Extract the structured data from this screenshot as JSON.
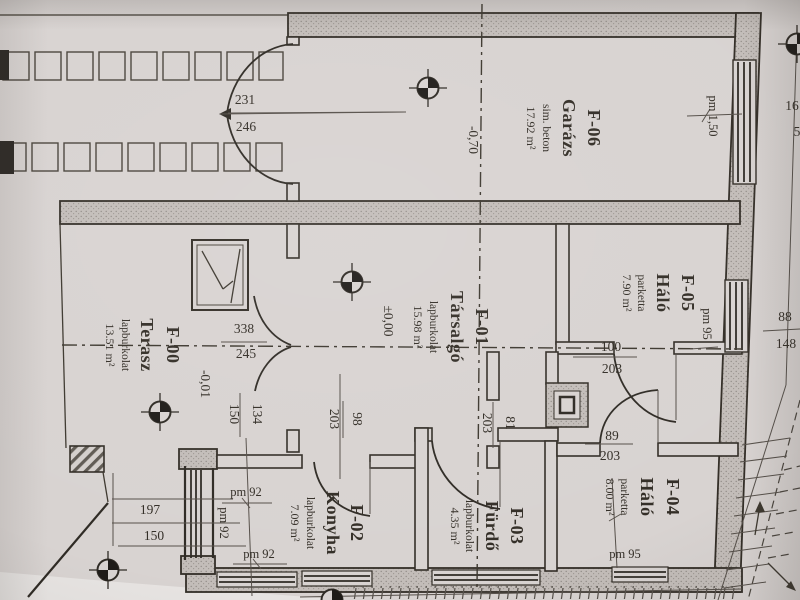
{
  "plan": {
    "rooms": [
      {
        "id": "F-06",
        "name": "Garázs",
        "floor": "sim. beton",
        "area": "17.92 m²"
      },
      {
        "id": "F-05",
        "name": "Háló",
        "floor": "parketta",
        "area": "7.90 m²"
      },
      {
        "id": "F-01",
        "name": "Társalgó",
        "floor": "lapburkolat",
        "area": "15.98 m²"
      },
      {
        "id": "F-00",
        "name": "Terasz",
        "floor": "lapburkolat",
        "area": "13.51 m²"
      },
      {
        "id": "F-02",
        "name": "Konyha",
        "floor": "lapburkolat",
        "area": "7.09 m²"
      },
      {
        "id": "F-03",
        "name": "Fürdő",
        "floor": "lapburkolat",
        "area": "4.35 m²"
      },
      {
        "id": "F-04",
        "name": "Háló",
        "floor": "parketta",
        "area": "8.00 m²"
      }
    ],
    "levels": {
      "garage": "-0,70",
      "lounge": "±0,00",
      "terrace": "-0,01"
    },
    "dims": {
      "garage_door_w": "231",
      "garage_door_h": "246",
      "terrace_door_w": "338",
      "terrace_door_h": "245",
      "terrace_step_w": "134",
      "terrace_step_h": "150",
      "kitchen_step_w": "197",
      "kitchen_step_h": "150",
      "kitchen_door_w": "98",
      "kitchen_door_h": "203",
      "hall_door_w": "81",
      "hall_door_h": "203",
      "bed5_door_w": "100",
      "bed5_door_h": "203",
      "bed4_door_w": "89",
      "bed4_door_h": "203",
      "wall_seg_w": "88",
      "wall_seg_h": "148",
      "pm_garage": "pm 1,50",
      "pm_bed5": "pm 95",
      "pm_bed4": "pm 95",
      "pm_kitchen_1": "pm 92",
      "pm_kitchen_2": "pm 92",
      "pm_kitchen_3": "pm 92",
      "edge_a": "16",
      "edge_b": "5"
    },
    "colors": {
      "ink": "#38332c",
      "paper": "#d8d3d1",
      "wall": "#c6c0bd"
    }
  }
}
